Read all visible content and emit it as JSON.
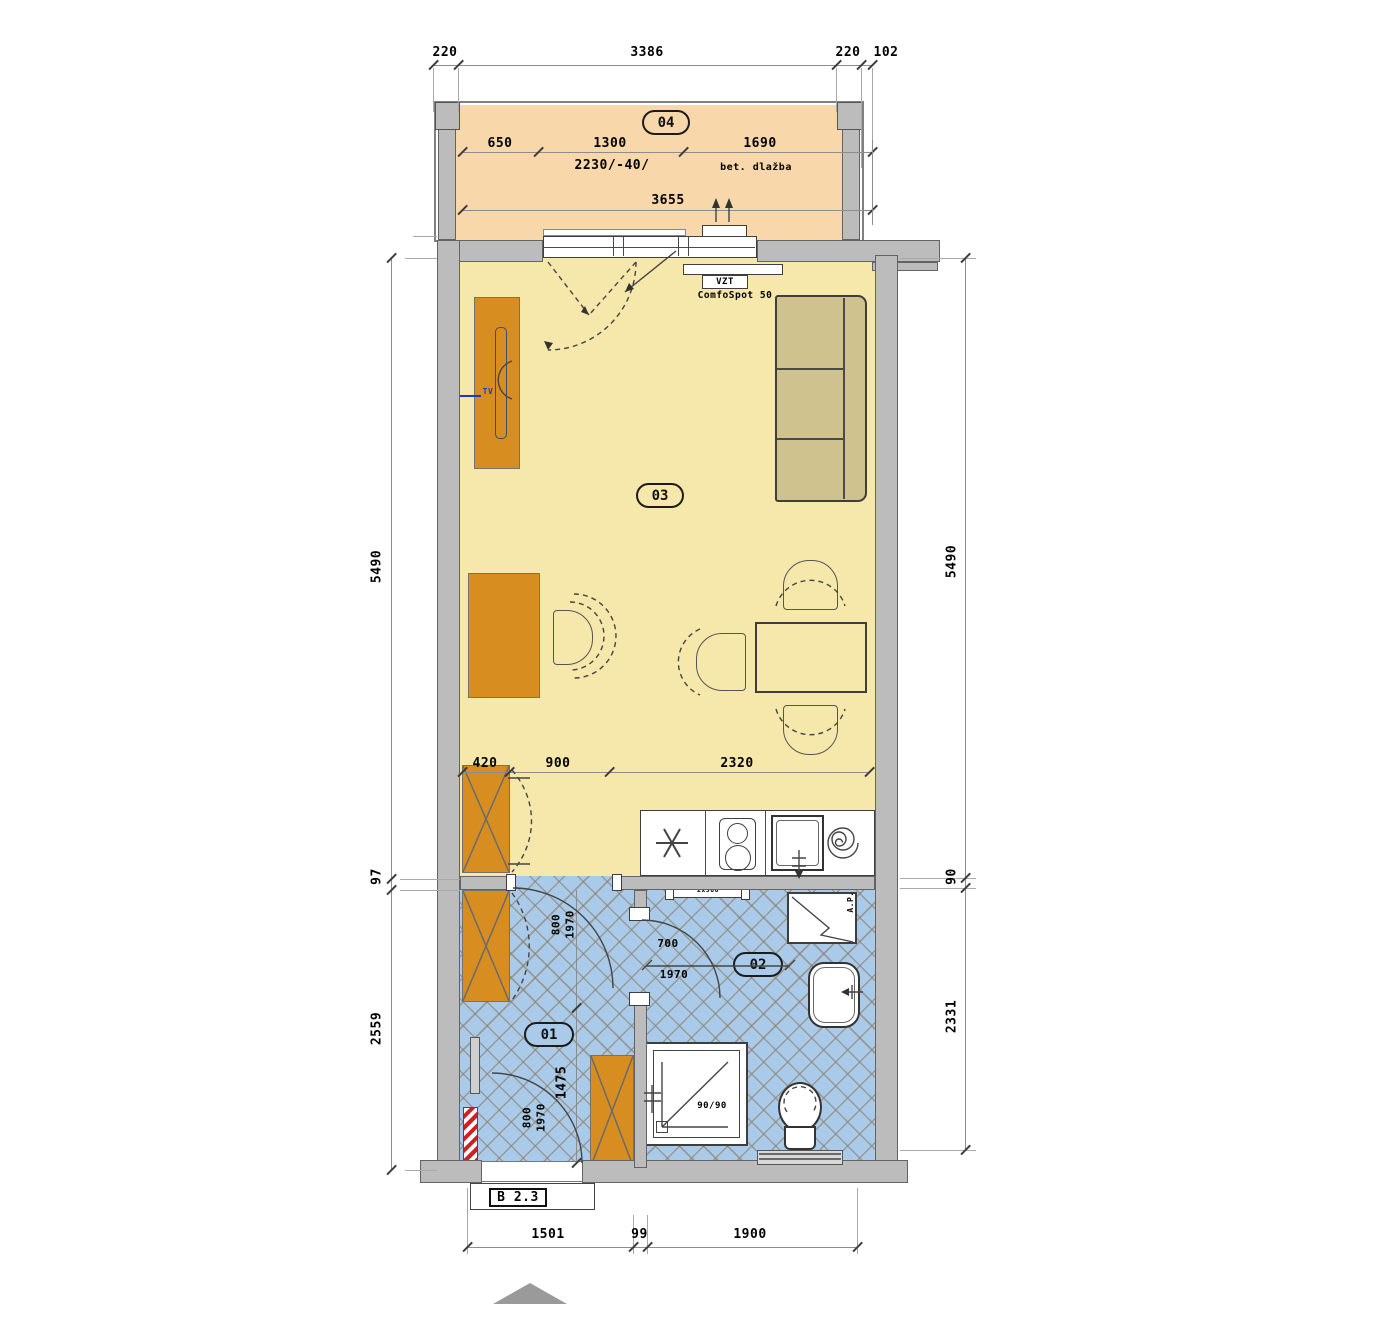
{
  "unit": {
    "code": "B 2.3"
  },
  "rooms": {
    "hall": {
      "id": "01"
    },
    "bath": {
      "id": "02"
    },
    "living": {
      "id": "03"
    },
    "balcony": {
      "id": "04",
      "material": "bet. dlažba"
    }
  },
  "devices": {
    "vzt_name": "VZT",
    "vzt_model": "ComfoSpot 50",
    "tv": "TV",
    "washer": "A.P.",
    "shower_size": "90/90",
    "radiator": "2x900"
  },
  "dims": {
    "top": [
      "220",
      "3386",
      "220",
      "102"
    ],
    "balcony_widths": [
      "650",
      "1300",
      "1690"
    ],
    "balcony_note": "2230/-40/",
    "balcony_total": "3655",
    "left": [
      "5490",
      "97",
      "2559"
    ],
    "right": [
      "5490",
      "90",
      "2331"
    ],
    "living_row": [
      "420",
      "900",
      "2320"
    ],
    "bottom": [
      "1501",
      "99",
      "1900"
    ],
    "hall_door": [
      "800",
      "1970"
    ],
    "bath_door": [
      "700",
      "1970"
    ],
    "entry_door": [
      "800",
      "1970"
    ],
    "hall_length": "1475"
  },
  "colors": {
    "balcony_floor": "#f8d8ab",
    "living_floor": "#f6e7ab",
    "bath_floor": "#a9cbe9",
    "furniture": "#d88d20",
    "wall": "#bcbcbc",
    "marker_red": "#cc2222"
  }
}
